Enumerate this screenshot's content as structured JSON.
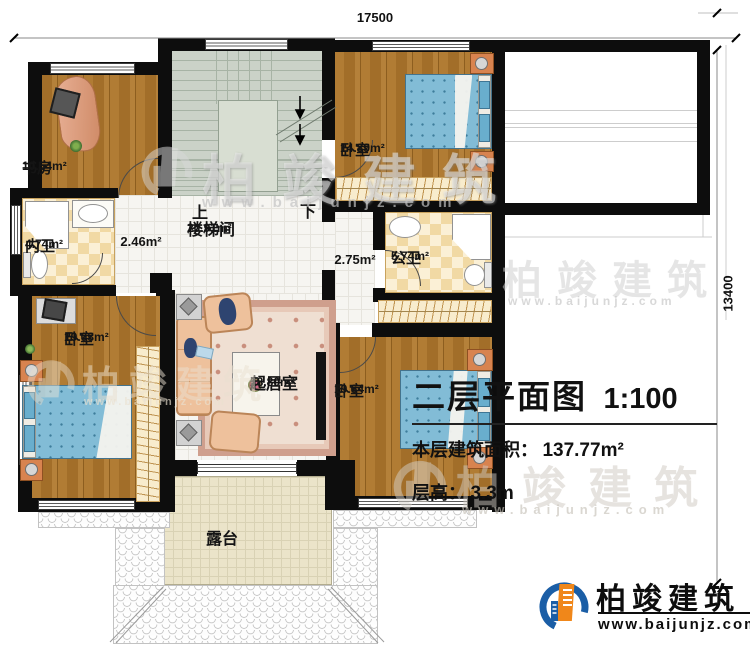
{
  "dimensions": {
    "width_label": "17500",
    "height_label": "13400"
  },
  "stairs": {
    "up": "上",
    "down": "下"
  },
  "rooms": {
    "study": {
      "name": "书房",
      "area": "10.54m²"
    },
    "inner_bath": {
      "name": "内卫",
      "area": "4.74m²"
    },
    "hall": {
      "area": "2.46m²"
    },
    "stairwell": {
      "name": "楼梯间",
      "area": "20.91m²"
    },
    "corridor": {
      "area": "2.75m²"
    },
    "bedroom_top": {
      "name": "卧室",
      "area": "14.89m²"
    },
    "public_bath": {
      "name": "公卫",
      "area": "5.74m²"
    },
    "bedroom_left": {
      "name": "卧室",
      "area": "19.03m²"
    },
    "living_room": {
      "name": "起居室",
      "area": "18.80m²"
    },
    "bedroom_right": {
      "name": "卧室",
      "area": "19.64m²"
    },
    "terrace": {
      "name": "露台"
    }
  },
  "title_block": {
    "title": "二层平面图",
    "scale": "1:100",
    "area_label": "本层建筑面积：",
    "area_value": "137.77m²",
    "height_label": "层高：",
    "height_value": "3.3m"
  },
  "brand": {
    "name": "柏竣建筑",
    "website": "www.baijunjz.com"
  },
  "watermark": {
    "text": "柏竣建筑",
    "website": "www.baijunjz.com"
  },
  "colors": {
    "wall": "#0d0d0d",
    "brand_blue": "#1b5ea6",
    "brand_orange": "#f0871a",
    "bed": "#82bcd6",
    "wood": "#a8742e"
  }
}
